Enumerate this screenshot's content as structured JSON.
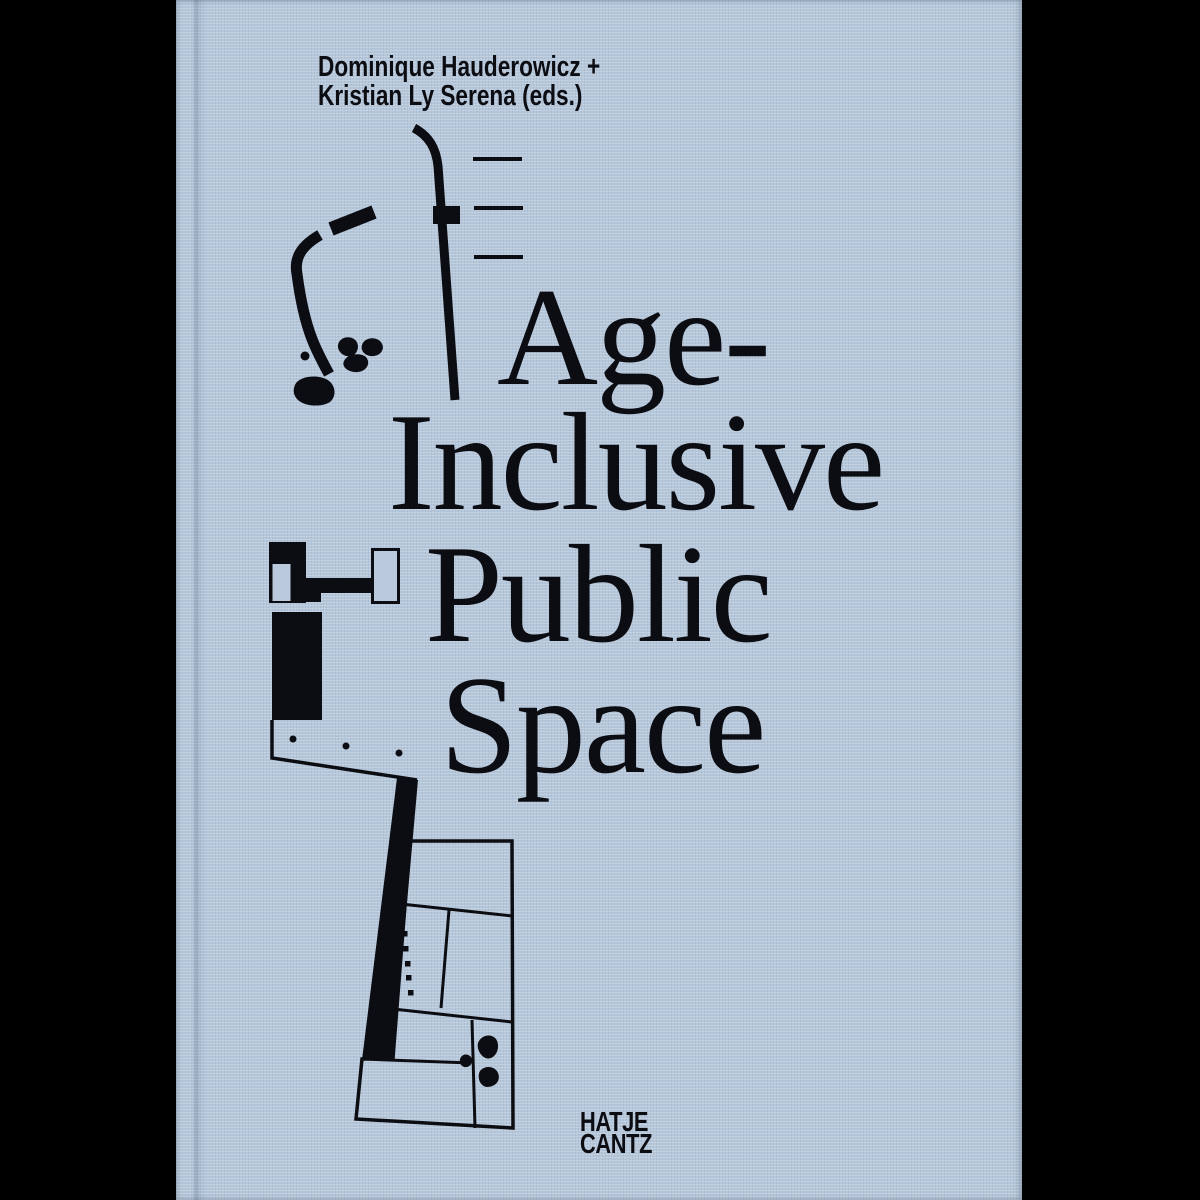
{
  "window": {
    "backdrop_color": "#000000"
  },
  "cover": {
    "background_color": "#b7c7da",
    "ink_color": "#0c0d12",
    "authors": {
      "line1": "Dominique Hauderowicz +",
      "line2": "Kristian Ly Serena (eds.)"
    },
    "title": {
      "line1": "Age-",
      "line2": "Inclusive",
      "line3": "Public",
      "line4": "Space"
    },
    "publisher": {
      "line1": "HATJE",
      "line2": "CANTZ"
    },
    "artwork": {
      "description": "black architectural site-plan line drawings printed on cloth cover",
      "elements": [
        "curved-path-with-stones-plan",
        "stair-steps-plan",
        "building-fragment-plan",
        "tilted-site-plan-with-columns-and-trees"
      ]
    }
  }
}
